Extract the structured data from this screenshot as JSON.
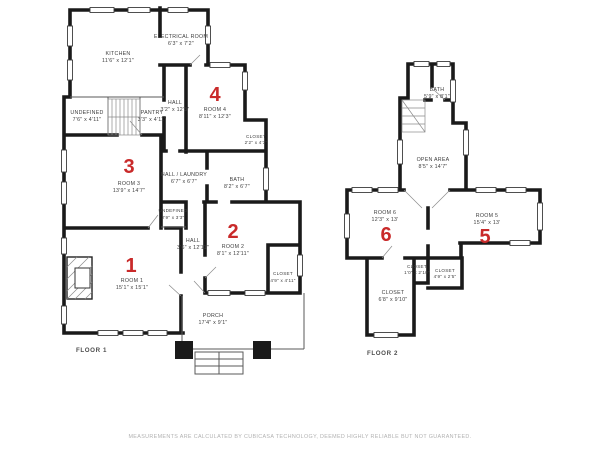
{
  "colors": {
    "accent_red": "#c92a2a",
    "wall": "#1a1a1a",
    "label": "#3e3e3e",
    "footer": "#b2b2b2"
  },
  "footer": {
    "text": "MEASUREMENTS ARE CALCULATED BY CUBICASA TECHNOLOGY, DEEMED HIGHLY RELIABLE BUT NOT GUARANTEED."
  },
  "floor1": {
    "title": "FLOOR 1",
    "rooms": [
      {
        "name": "KITCHEN",
        "dims": "11'6\" x 12'1\""
      },
      {
        "name": "ELECTRICAL ROOM",
        "dims": "6'3\" x 7'2\""
      },
      {
        "name": "UNDEFINED",
        "dims": "7'6\" x 4'11\""
      },
      {
        "name": "PANTRY",
        "dims": "3'3\" x 4'11\""
      },
      {
        "name": "HALL",
        "dims": "3'2\" x 12'3\""
      },
      {
        "name": "ROOM 4",
        "dims": "8'11\" x 12'3\"",
        "number": "4"
      },
      {
        "name": "CLOSET",
        "dims": "2'2\" x 4'3\""
      },
      {
        "name": "ROOM 3",
        "dims": "13'9\" x 14'7\"",
        "number": "3"
      },
      {
        "name": "HALL / LAUNDRY",
        "dims": "6'7\" x 6'7\""
      },
      {
        "name": "UNDEFINED",
        "dims": "2'9\" x 3'3\""
      },
      {
        "name": "BATH",
        "dims": "8'2\" x 6'7\""
      },
      {
        "name": "HALL",
        "dims": "3'6\" x 12'11\""
      },
      {
        "name": "ROOM 2",
        "dims": "8'1\" x 12'11\"",
        "number": "2"
      },
      {
        "name": "CLOSET",
        "dims": "4'9\" x 4'11\""
      },
      {
        "name": "ROOM 1",
        "dims": "15'1\" x 15'1\"",
        "number": "1"
      },
      {
        "name": "PORCH",
        "dims": "17'4\" x 9'1\""
      }
    ]
  },
  "floor2": {
    "title": "FLOOR 2",
    "rooms": [
      {
        "name": "BATH",
        "dims": "5'9\" x 8'1\""
      },
      {
        "name": "OPEN AREA",
        "dims": "8'5\" x 14'7\""
      },
      {
        "name": "ROOM 6",
        "dims": "12'3\" x 13'",
        "number": "6"
      },
      {
        "name": "ROOM 5",
        "dims": "15'4\" x 13'",
        "number": "5"
      },
      {
        "name": "CLOSET",
        "dims": "1'0\" x 2'10\""
      },
      {
        "name": "CLOSET",
        "dims": "4'9\" x 2'5\""
      },
      {
        "name": "CLOSET",
        "dims": "6'8\" x 9'10\""
      }
    ]
  }
}
